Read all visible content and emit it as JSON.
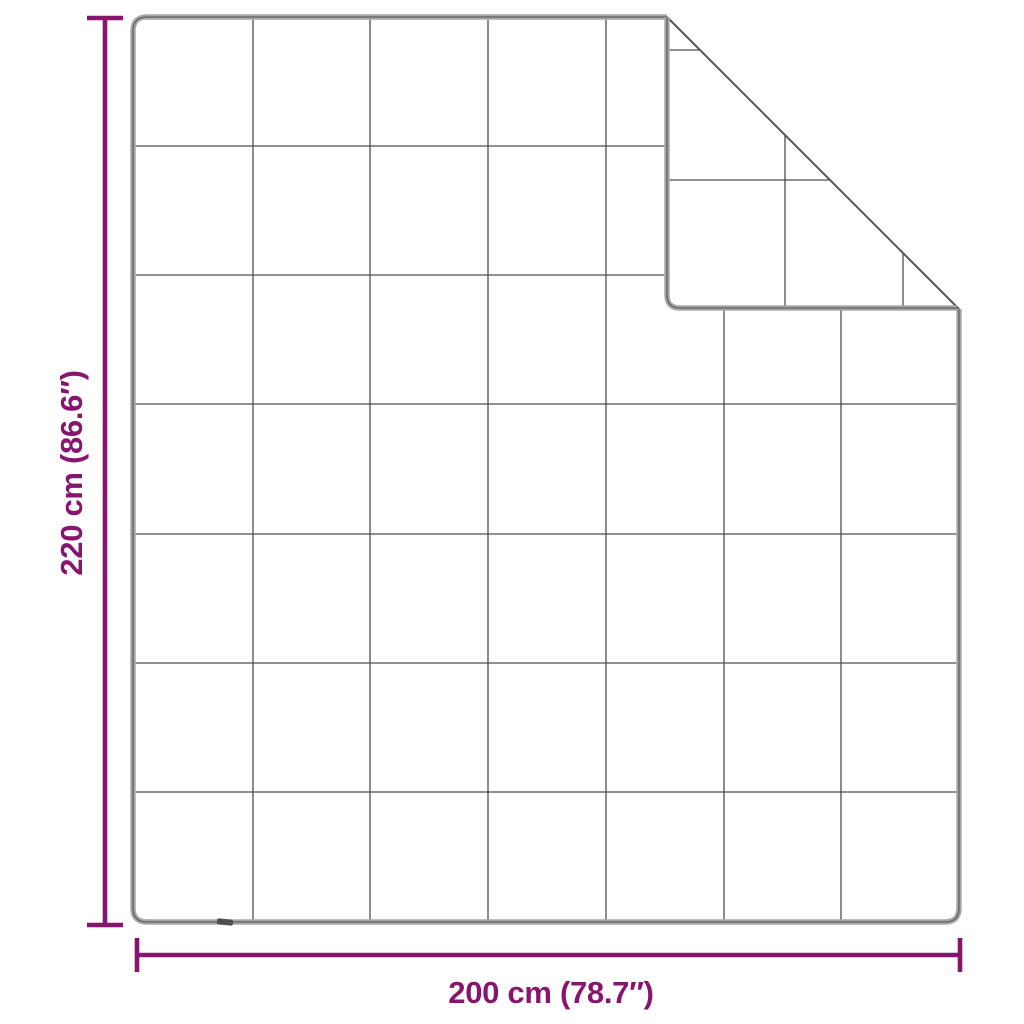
{
  "diagram": {
    "title": "weighted blanket dimension diagram",
    "subject": "quilted blanket with folded top-right corner",
    "grid_rows": 7,
    "grid_columns": 7,
    "height": {
      "label": "220 cm (86.6″)",
      "value_cm": 220,
      "value_in": 86.6
    },
    "width": {
      "label": "200 cm (78.7″)",
      "value_cm": 200,
      "value_in": 78.7
    }
  },
  "colors": {
    "dimension_accent": "#871570",
    "blanket_edge": "#a8a8a8",
    "blanket_edge_core": "#5e5e5e",
    "fold_crease": "#555555",
    "quilt_grid": "#4d4d4d",
    "background": "#ffffff"
  }
}
